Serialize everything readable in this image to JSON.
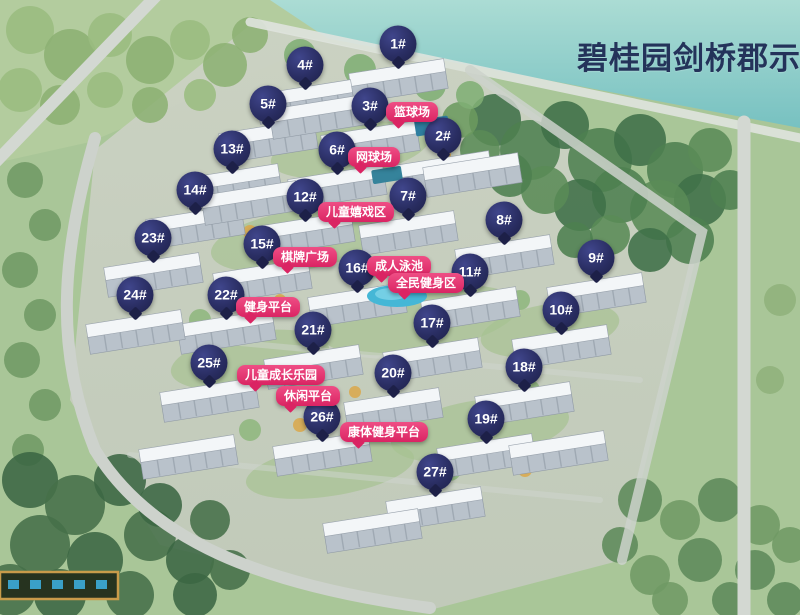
{
  "title": "碧桂园剑桥郡示",
  "colors": {
    "marker_bg": "#2a2e63",
    "amenity_bg": "#da2463",
    "title_color": "#24335a"
  },
  "markers": [
    {
      "label": "1#",
      "x": 398,
      "y": 44
    },
    {
      "label": "2#",
      "x": 443,
      "y": 136
    },
    {
      "label": "3#",
      "x": 370,
      "y": 106
    },
    {
      "label": "4#",
      "x": 305,
      "y": 65
    },
    {
      "label": "5#",
      "x": 268,
      "y": 104
    },
    {
      "label": "6#",
      "x": 337,
      "y": 150
    },
    {
      "label": "7#",
      "x": 408,
      "y": 196
    },
    {
      "label": "8#",
      "x": 504,
      "y": 220
    },
    {
      "label": "9#",
      "x": 596,
      "y": 258
    },
    {
      "label": "10#",
      "x": 561,
      "y": 310
    },
    {
      "label": "11#",
      "x": 470,
      "y": 272
    },
    {
      "label": "12#",
      "x": 305,
      "y": 197
    },
    {
      "label": "13#",
      "x": 232,
      "y": 149
    },
    {
      "label": "14#",
      "x": 195,
      "y": 190
    },
    {
      "label": "15#",
      "x": 262,
      "y": 244
    },
    {
      "label": "16#",
      "x": 357,
      "y": 268
    },
    {
      "label": "17#",
      "x": 432,
      "y": 323
    },
    {
      "label": "18#",
      "x": 524,
      "y": 367
    },
    {
      "label": "19#",
      "x": 486,
      "y": 419
    },
    {
      "label": "20#",
      "x": 393,
      "y": 373
    },
    {
      "label": "21#",
      "x": 313,
      "y": 330
    },
    {
      "label": "22#",
      "x": 226,
      "y": 295
    },
    {
      "label": "23#",
      "x": 153,
      "y": 238
    },
    {
      "label": "24#",
      "x": 135,
      "y": 295
    },
    {
      "label": "25#",
      "x": 209,
      "y": 363
    },
    {
      "label": "26#",
      "x": 322,
      "y": 417
    },
    {
      "label": "27#",
      "x": 435,
      "y": 472
    }
  ],
  "amenities": [
    {
      "label": "篮球场",
      "x": 412,
      "y": 112
    },
    {
      "label": "网球场",
      "x": 374,
      "y": 157
    },
    {
      "label": "儿童嬉戏区",
      "x": 356,
      "y": 212
    },
    {
      "label": "棋牌广场",
      "x": 305,
      "y": 257
    },
    {
      "label": "成人泳池",
      "x": 399,
      "y": 266
    },
    {
      "label": "全民健身区",
      "x": 426,
      "y": 283
    },
    {
      "label": "健身平台",
      "x": 268,
      "y": 307
    },
    {
      "label": "儿童成长乐园",
      "x": 281,
      "y": 375
    },
    {
      "label": "休闲平台",
      "x": 308,
      "y": 396
    },
    {
      "label": "康体健身平台",
      "x": 384,
      "y": 432
    }
  ]
}
